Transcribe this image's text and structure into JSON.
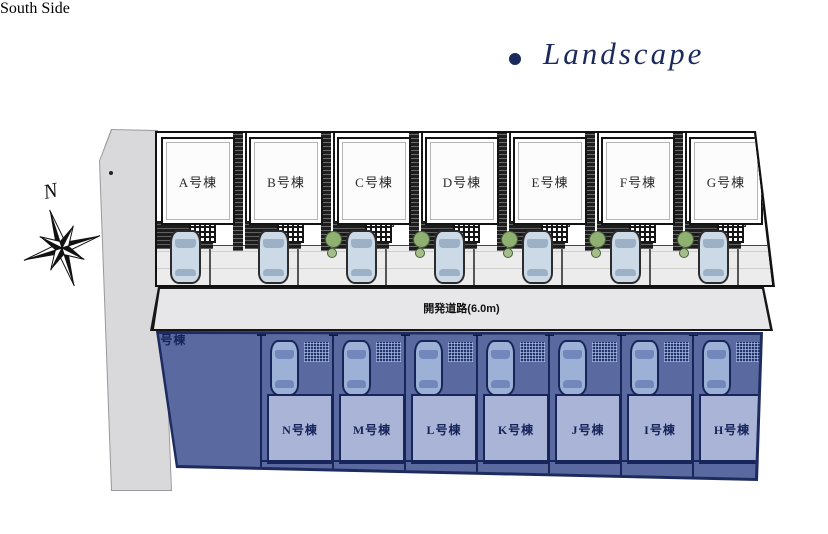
{
  "header": {
    "title": "Landscape"
  },
  "compass": {
    "north_label": "N"
  },
  "road": {
    "label": "開発道路(6.0m)"
  },
  "north_section": {
    "buildings": [
      {
        "label": "A号棟"
      },
      {
        "label": "B号棟"
      },
      {
        "label": "C号棟"
      },
      {
        "label": "D号棟"
      },
      {
        "label": "E号棟"
      },
      {
        "label": "F号棟"
      },
      {
        "label": "G号棟"
      }
    ]
  },
  "south_section": {
    "overlay_label": "South Side",
    "buildings": [
      {
        "label": "O号棟"
      },
      {
        "label": "N号棟"
      },
      {
        "label": "M号棟"
      },
      {
        "label": "L号棟"
      },
      {
        "label": "K号棟"
      },
      {
        "label": "J号棟"
      },
      {
        "label": "I号棟"
      },
      {
        "label": "H号棟"
      }
    ]
  },
  "colors": {
    "accent_navy": "#1b2a5c",
    "south_bg": "#5a69a0",
    "south_building": "#aab4d6",
    "road_gray": "#e7e7e9",
    "side_road_gray": "#d9d9dc",
    "overlay_text": "#ffffff"
  }
}
